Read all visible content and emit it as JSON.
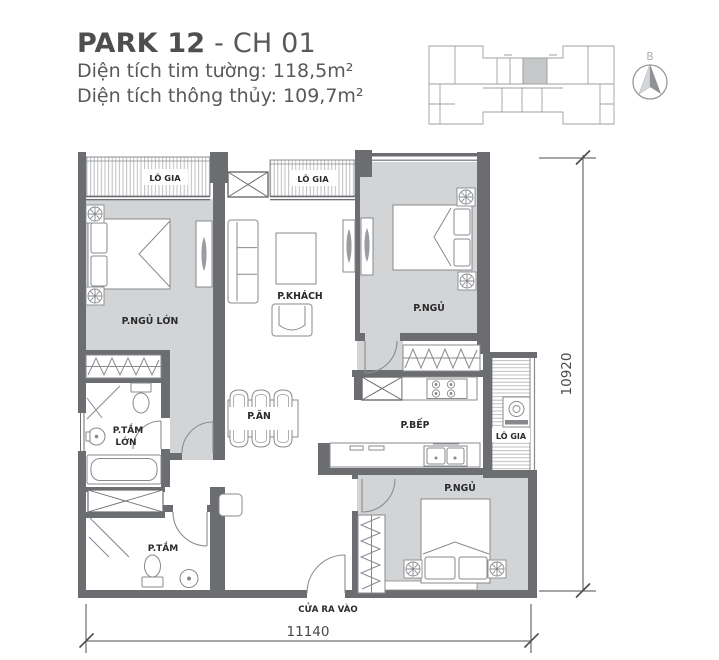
{
  "header": {
    "title_primary": "PARK 12",
    "title_separator": " - ",
    "title_secondary": "CH 01",
    "area_line1": "Diện tích tim tường: 118,5m²",
    "area_line2": "Diện tích thông thủy: 109,7m²"
  },
  "compass": {
    "north_label": "B"
  },
  "rooms": {
    "balcony_top_left": "LÔ GIA",
    "balcony_top_center": "LÔ GIA",
    "balcony_right": "LÔ GIA",
    "master_bedroom": "P.NGỦ LỚN",
    "living_room": "P.KHÁCH",
    "bedroom_top_right": "P.NGỦ",
    "bedroom_bottom": "P.NGỦ",
    "dining_room": "P.ĂN",
    "kitchen": "P.BẾP",
    "master_bathroom_line1": "P.TẮM",
    "master_bathroom_line2": "LỚN",
    "bathroom_2": "P.TẮM",
    "entrance": "CỬA RA VÀO"
  },
  "dimensions": {
    "bottom_width": "11140",
    "right_height": "10920"
  }
}
